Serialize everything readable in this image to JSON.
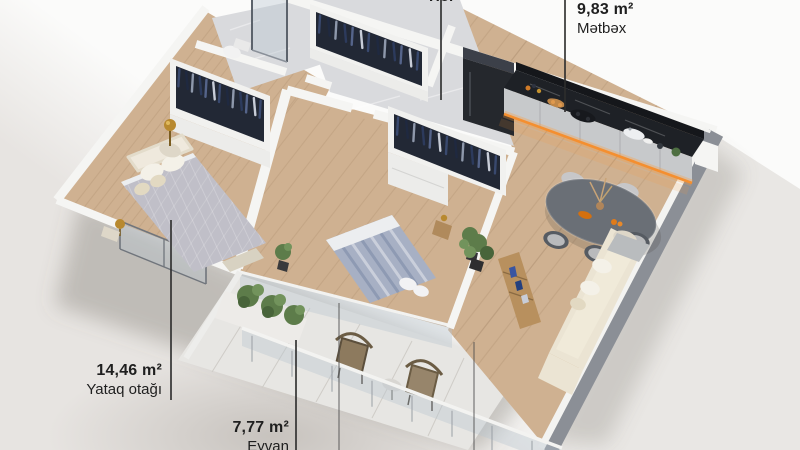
{
  "meta": {
    "view": "3D apartment floor plan render",
    "language": "Azerbaijani"
  },
  "labels": {
    "hol": {
      "name": "Hol"
    },
    "metbex": {
      "area": "9,83 m²",
      "name": "Mətbəx"
    },
    "yataq": {
      "area": "14,46 m²",
      "name": "Yataq otağı"
    },
    "eyvan": {
      "area": "7,77 m²",
      "name": "Eyvan"
    }
  },
  "rooms": [
    "Hol",
    "Mətbəx",
    "Yataq otağı",
    "Eyvan"
  ],
  "colors": {
    "text": "#1f1f1f",
    "wood": "#cfb191",
    "woodLine": "rgba(122,90,58,0.12)",
    "marble": "#d9dadd",
    "marbleVein": "rgba(255,255,255,0.6)",
    "wall": "#f5f5f3",
    "wallSoft": "#ededeb",
    "wallGrayTop": "#8b8f96",
    "counterBlack": "#1e2126",
    "backsplash": "#15171b",
    "cabinet": "#c7c9cb",
    "ledOrange": "#f08a2c",
    "fridge": "#25282d",
    "fridgeTop": "#3c4049",
    "tableGray": "#6a6f76",
    "chairDark": "#565b62",
    "chairLight": "#c7c7c9",
    "sofaCream": "#ebe4d3",
    "sofaSeat": "#f0ead9",
    "pillowWhite": "#f4f1e8",
    "bed1": "#c0bfc8",
    "bed1Sheet": "#eceef0",
    "bed2": "#a7b0c4",
    "bed2Stripe": "#8e9ab3",
    "closetDark": "#222835",
    "plant": "#5d7c4a",
    "plantDark": "#48643a",
    "plantLight": "#72935c",
    "gold": "#b8892f",
    "glass": "rgba(185,196,208,0.38)",
    "glassFrame": "#70757c",
    "wicker": "#8d7a5e",
    "wicker2": "#97856b",
    "consoleWood": "#b8905e",
    "blueDecor": "#3a55a0",
    "shadow": "rgba(110,102,94,0.32)",
    "balconyFloor": "#e7e6e3",
    "cream": "#ded7c8"
  }
}
